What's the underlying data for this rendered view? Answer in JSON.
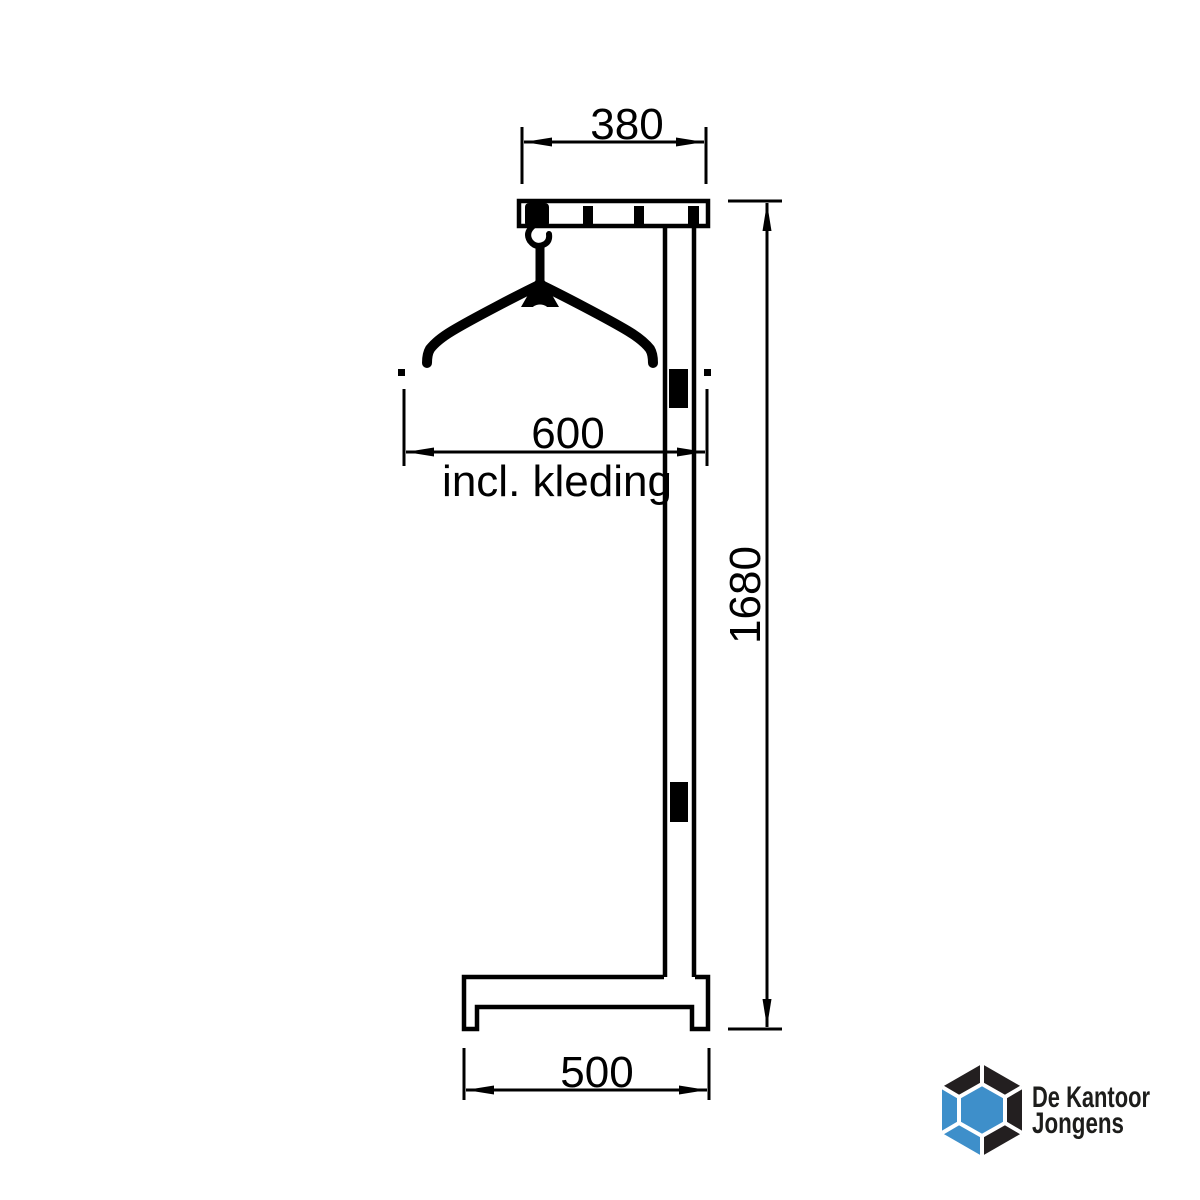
{
  "page": {
    "background": "#ffffff"
  },
  "colors": {
    "line": "#000000",
    "text": "#000000"
  },
  "diagram": {
    "type": "technical-drawing",
    "subject": "coat rack (kapstok) side elevation with coat hanger",
    "dimensions": {
      "top_width": "380",
      "hanger_width": "600",
      "hanger_width_note": "incl. kleding",
      "height": "1680",
      "base_width": "500"
    }
  },
  "logo": {
    "name_line1": "De Kantoor",
    "name_line2": "Jongens",
    "text_color": "#1d1d1b",
    "mark_blue": "#3e8fca",
    "mark_black": "#231f20",
    "seam_color": "#ffffff"
  }
}
